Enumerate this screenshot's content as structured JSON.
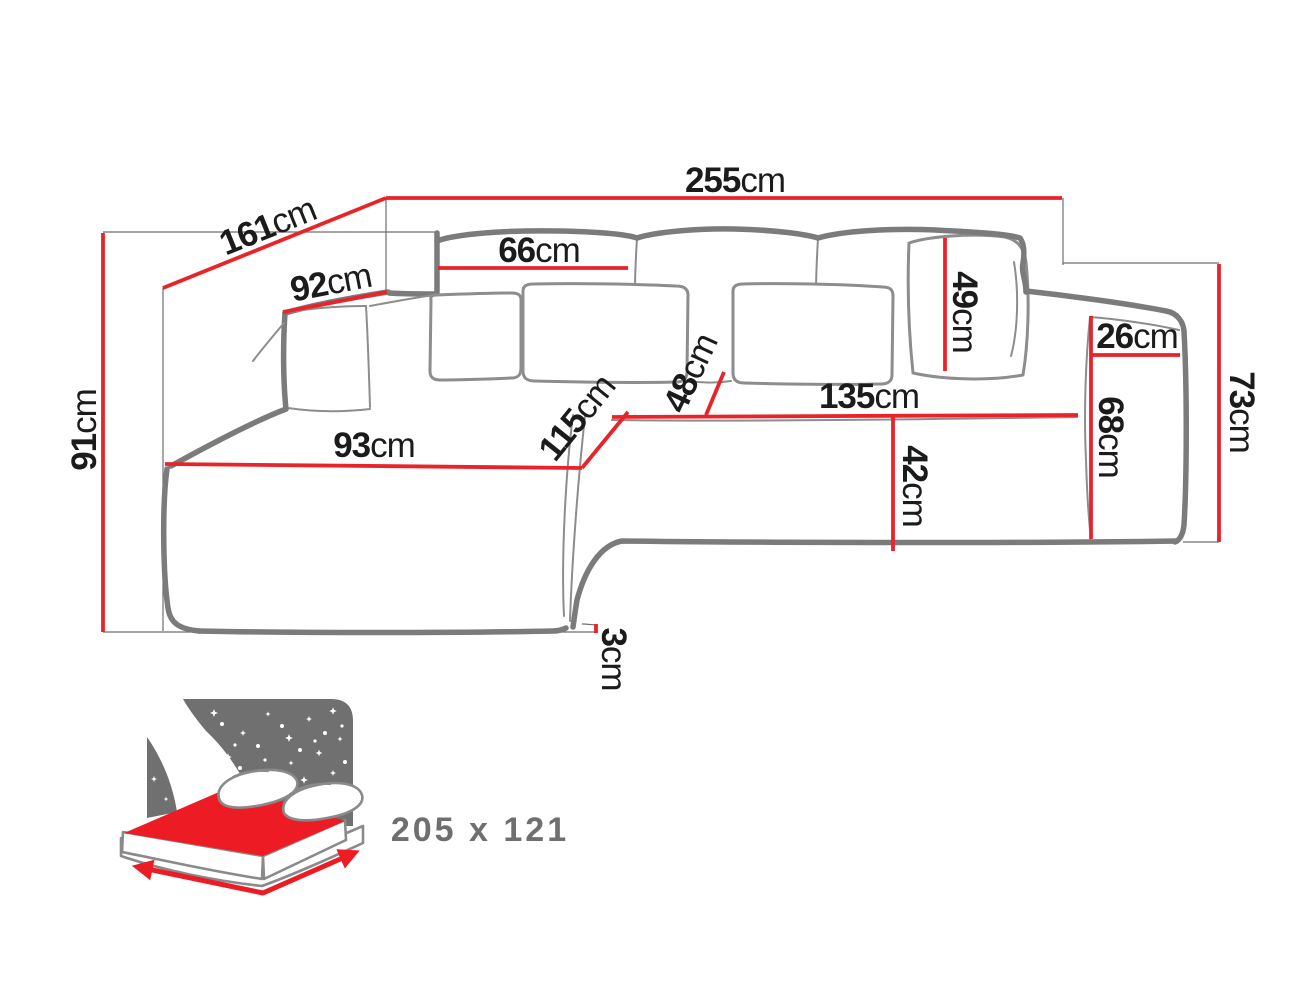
{
  "diagram": {
    "type": "corner-sofa-dimension-diagram",
    "unit": "cm",
    "dimensions": {
      "total_width": "255",
      "chaise_length": "161",
      "corner_back_width": "92",
      "back_cushion_width": "66",
      "back_cushion_height": "49",
      "armrest_top_depth": "26",
      "armrest_front_height": "68",
      "armrest_total_height": "73",
      "total_height": "91",
      "chaise_width": "93",
      "chaise_seat_length": "115",
      "seat_depth": "48",
      "seat_width": "135",
      "seat_front_height": "42",
      "bottom_clearance": "3"
    },
    "sleeping_function": {
      "label": "205 x 121",
      "icon": "sleeping-function-bed-icon"
    },
    "colors": {
      "dimension_line": "#e8232a",
      "sofa_outline": "#7b7b7b",
      "label_text": "#1b1b1b",
      "icon_panel": "#707070",
      "icon_mattress": "#ed1c24",
      "size_label_text": "#6f6f6f"
    }
  }
}
